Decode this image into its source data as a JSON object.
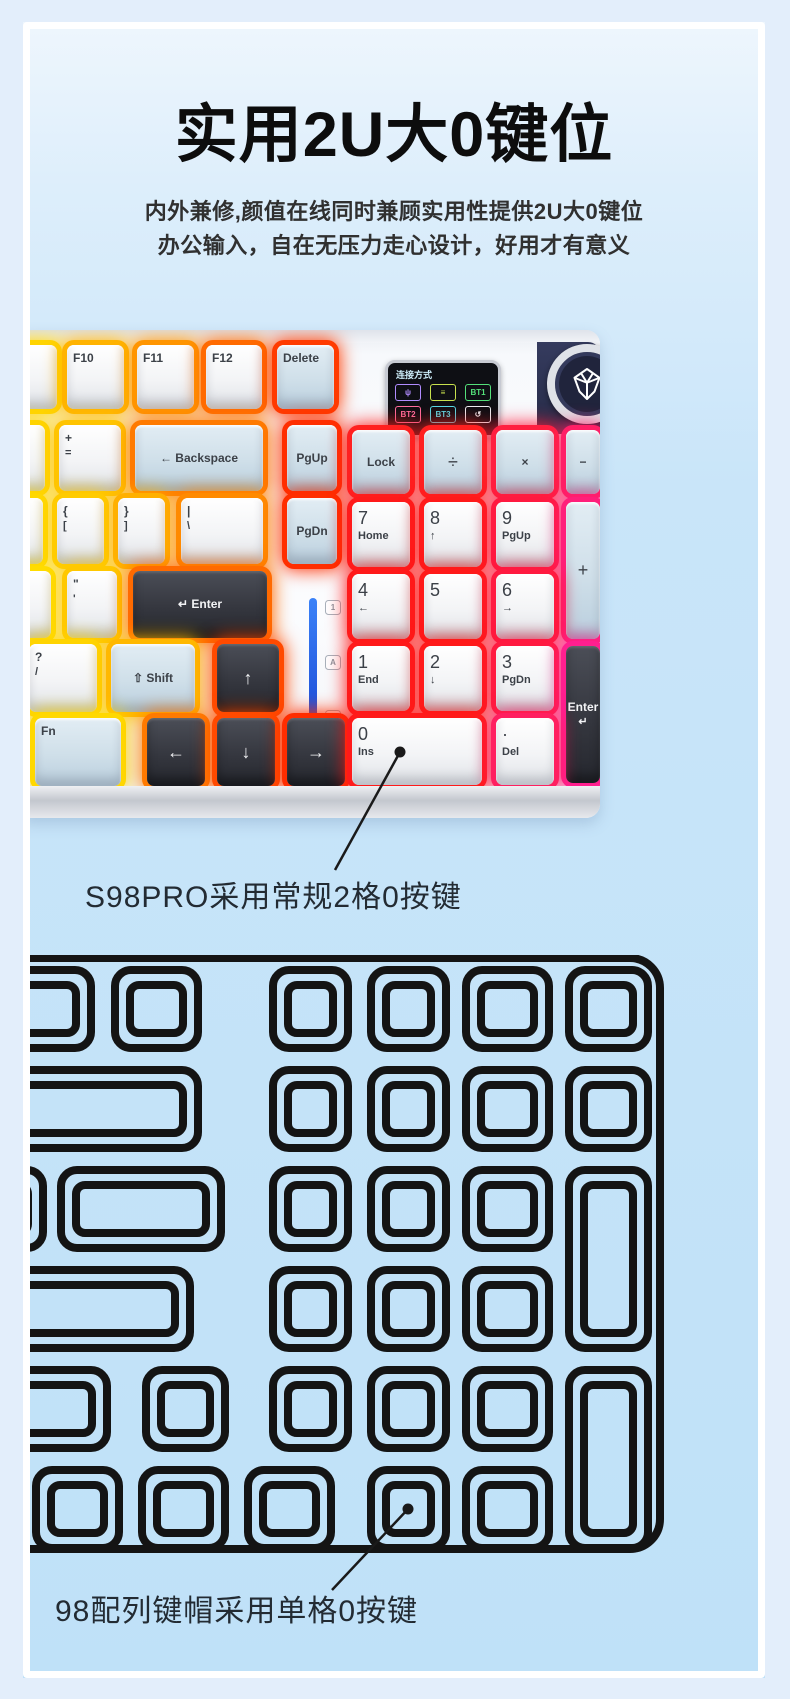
{
  "page": {
    "title": "实用2U大0键位",
    "subtitle_line1": "内外兼修,颜值在线同时兼顾实用性提供2U大0键位",
    "subtitle_line2": "办公输入，自在无压力走心设计，好用才有意义",
    "callout_photo": "S98PRO采用常规2格0按键",
    "callout_lineart": "98配列键帽采用单格0按键"
  },
  "colors": {
    "lineart_stroke": "#141414",
    "callout_line": "#1a1a1a",
    "annotation_text": "#232b33",
    "indicator_bar": "#2b6bf3",
    "knob_panel": "#2b3050"
  },
  "screen": {
    "label": "连接方式",
    "icons": [
      {
        "name": "usb-icon",
        "glyph": "ψ",
        "color": "#b18cff"
      },
      {
        "name": "wired-icon",
        "glyph": "≡",
        "color": "#c8e14e"
      },
      {
        "name": "bt1-badge",
        "glyph": "BT1",
        "color": "#54e07a"
      },
      {
        "name": "bt2-badge",
        "glyph": "BT2",
        "color": "#ff6e9e"
      },
      {
        "name": "bt3-badge",
        "glyph": "BT3",
        "color": "#55dbe8"
      },
      {
        "name": "return-icon",
        "glyph": "↺",
        "color": "#eceff3"
      }
    ]
  },
  "indicators": [
    "1",
    "A",
    "⇩"
  ],
  "photo_keys": [
    {
      "x": -14,
      "y": 15,
      "w": 48,
      "h": 64,
      "glow": "#ffd400",
      "style": "w",
      "label": "F9"
    },
    {
      "x": 44,
      "y": 15,
      "w": 57,
      "h": 64,
      "glow": "#ffb300",
      "style": "w",
      "label": "F10"
    },
    {
      "x": 114,
      "y": 15,
      "w": 57,
      "h": 64,
      "glow": "#ff9500",
      "style": "w",
      "label": "F11"
    },
    {
      "x": 183,
      "y": 15,
      "w": 56,
      "h": 64,
      "glow": "#ff6a00",
      "style": "w",
      "label": "F12"
    },
    {
      "x": 254,
      "y": 15,
      "w": 57,
      "h": 64,
      "glow": "#ff3b00",
      "style": "b",
      "label": "Delete"
    },
    {
      "x": -14,
      "y": 95,
      "w": 36,
      "h": 66,
      "glow": "#ffd400",
      "style": "w",
      "label": "-"
    },
    {
      "x": 36,
      "y": 95,
      "w": 62,
      "h": 66,
      "glow": "#ffc400",
      "style": "w",
      "label": "+",
      "sub": "="
    },
    {
      "x": 112,
      "y": 95,
      "w": 128,
      "h": 66,
      "glow": "#ff7a00",
      "style": "b",
      "label": "← Backspace",
      "center": true
    },
    {
      "x": 264,
      "y": 95,
      "w": 50,
      "h": 66,
      "glow": "#ff2e00",
      "style": "b",
      "label": "PgUp",
      "center": true
    },
    {
      "x": -14,
      "y": 168,
      "w": 34,
      "h": 66,
      "glow": "#ffd800",
      "style": "w",
      "label": ""
    },
    {
      "x": 34,
      "y": 168,
      "w": 47,
      "h": 66,
      "glow": "#ffcb00",
      "style": "w",
      "label": "{",
      "sub": "["
    },
    {
      "x": 95,
      "y": 168,
      "w": 47,
      "h": 66,
      "glow": "#ffb000",
      "style": "w",
      "label": "}",
      "sub": "]"
    },
    {
      "x": 158,
      "y": 168,
      "w": 82,
      "h": 66,
      "glow": "#ff8a00",
      "style": "w",
      "label": "|",
      "sub": "\\"
    },
    {
      "x": 264,
      "y": 168,
      "w": 50,
      "h": 66,
      "glow": "#ff2e00",
      "style": "b",
      "label": "PgDn",
      "center": true
    },
    {
      "x": -14,
      "y": 241,
      "w": 42,
      "h": 67,
      "glow": "#ffdc00",
      "style": "w",
      "label": ""
    },
    {
      "x": 44,
      "y": 241,
      "w": 50,
      "h": 67,
      "glow": "#ffc800",
      "style": "w",
      "label": "\"",
      "sub": "'"
    },
    {
      "x": 110,
      "y": 241,
      "w": 134,
      "h": 67,
      "glow": "#ff6a00",
      "style": "d",
      "label": "↵ Enter",
      "center": true
    },
    {
      "x": 6,
      "y": 314,
      "w": 68,
      "h": 68,
      "glow": "#ffd400",
      "style": "w",
      "label": "?",
      "sub": "/"
    },
    {
      "x": 88,
      "y": 314,
      "w": 84,
      "h": 68,
      "glow": "#ffb800",
      "style": "b",
      "label": "⇧ Shift",
      "center": true
    },
    {
      "x": 194,
      "y": 314,
      "w": 62,
      "h": 68,
      "glow": "#ff4a00",
      "style": "d",
      "label": "↑",
      "center": true,
      "big": true
    },
    {
      "x": 12,
      "y": 388,
      "w": 86,
      "h": 68,
      "glow": "#ffd800",
      "style": "b",
      "label": "Fn"
    },
    {
      "x": 124,
      "y": 388,
      "w": 58,
      "h": 68,
      "glow": "#ff7a00",
      "style": "d",
      "label": "←",
      "center": true,
      "big": true
    },
    {
      "x": 194,
      "y": 388,
      "w": 58,
      "h": 68,
      "glow": "#ff4a00",
      "style": "d",
      "label": "↓",
      "center": true,
      "big": true
    },
    {
      "x": 264,
      "y": 388,
      "w": 58,
      "h": 68,
      "glow": "#ff2d00",
      "style": "d",
      "label": "→",
      "center": true,
      "big": true
    },
    {
      "x": 329,
      "y": 100,
      "w": 58,
      "h": 64,
      "glow": "#ff2020",
      "style": "b",
      "label": "Lock",
      "center": true
    },
    {
      "x": 401,
      "y": 100,
      "w": 58,
      "h": 64,
      "glow": "#ff2020",
      "style": "b",
      "label": "÷",
      "center": true,
      "big": true
    },
    {
      "x": 473,
      "y": 100,
      "w": 58,
      "h": 64,
      "glow": "#ff2040",
      "style": "b",
      "label": "×",
      "center": true
    },
    {
      "x": 543,
      "y": 100,
      "w": 34,
      "h": 64,
      "glow": "#ff1f66",
      "style": "b",
      "label": "−",
      "center": true
    },
    {
      "x": 329,
      "y": 172,
      "w": 58,
      "h": 65,
      "glow": "#ff1a1a",
      "style": "w",
      "label": "7",
      "sub": "Home",
      "big": true
    },
    {
      "x": 401,
      "y": 172,
      "w": 58,
      "h": 65,
      "glow": "#ff1a1a",
      "style": "w",
      "label": "8",
      "sub": "↑",
      "big": true
    },
    {
      "x": 473,
      "y": 172,
      "w": 58,
      "h": 65,
      "glow": "#ff1a40",
      "style": "w",
      "label": "9",
      "sub": "PgUp",
      "big": true
    },
    {
      "x": 543,
      "y": 172,
      "w": 34,
      "h": 137,
      "glow": "#ff1f7a",
      "style": "b",
      "label": "+",
      "center": true,
      "big": true
    },
    {
      "x": 329,
      "y": 244,
      "w": 58,
      "h": 65,
      "glow": "#ff1a1a",
      "style": "w",
      "label": "4",
      "sub": "←",
      "big": true
    },
    {
      "x": 401,
      "y": 244,
      "w": 58,
      "h": 65,
      "glow": "#ff1a1a",
      "style": "w",
      "label": "5",
      "big": true
    },
    {
      "x": 473,
      "y": 244,
      "w": 58,
      "h": 65,
      "glow": "#ff1a40",
      "style": "w",
      "label": "6",
      "sub": "→",
      "big": true
    },
    {
      "x": 329,
      "y": 316,
      "w": 58,
      "h": 65,
      "glow": "#ff1a1a",
      "style": "w",
      "label": "1",
      "sub": "End",
      "big": true
    },
    {
      "x": 401,
      "y": 316,
      "w": 58,
      "h": 65,
      "glow": "#ff1a1a",
      "style": "w",
      "label": "2",
      "sub": "↓",
      "big": true
    },
    {
      "x": 473,
      "y": 316,
      "w": 58,
      "h": 65,
      "glow": "#ff1a40",
      "style": "w",
      "label": "3",
      "sub": "PgDn",
      "big": true
    },
    {
      "x": 543,
      "y": 316,
      "w": 34,
      "h": 137,
      "glow": "#ff1f8f",
      "style": "d",
      "label": "Enter",
      "sub": "↵",
      "center": true
    },
    {
      "x": 329,
      "y": 388,
      "w": 130,
      "h": 67,
      "glow": "#ff1a1a",
      "style": "w",
      "label": "0",
      "sub": "Ins",
      "big": true
    },
    {
      "x": 473,
      "y": 388,
      "w": 58,
      "h": 67,
      "glow": "#ff1f60",
      "style": "w",
      "label": "·",
      "sub": "Del",
      "big": true
    }
  ],
  "lineart": {
    "outline": {
      "x": -200,
      "y": 3,
      "w": 837,
      "h": 591,
      "rx": 30
    },
    "keys": [
      [
        -70,
        15,
        138,
        78
      ],
      [
        92,
        15,
        83,
        78
      ],
      [
        250,
        15,
        75,
        78
      ],
      [
        348,
        15,
        75,
        78
      ],
      [
        443,
        15,
        83,
        78
      ],
      [
        546,
        15,
        79,
        78
      ],
      [
        -70,
        115,
        245,
        78
      ],
      [
        250,
        115,
        75,
        78
      ],
      [
        348,
        115,
        75,
        78
      ],
      [
        443,
        115,
        83,
        78
      ],
      [
        546,
        115,
        79,
        78
      ],
      [
        -70,
        215,
        90,
        78
      ],
      [
        38,
        215,
        160,
        78
      ],
      [
        250,
        215,
        75,
        78
      ],
      [
        348,
        215,
        75,
        78
      ],
      [
        443,
        215,
        83,
        78
      ],
      [
        546,
        215,
        79,
        178
      ],
      [
        -70,
        315,
        237,
        78
      ],
      [
        250,
        315,
        75,
        78
      ],
      [
        348,
        315,
        75,
        78
      ],
      [
        443,
        315,
        83,
        78
      ],
      [
        -70,
        415,
        154,
        78
      ],
      [
        123,
        415,
        79,
        78
      ],
      [
        250,
        415,
        75,
        78
      ],
      [
        348,
        415,
        75,
        78
      ],
      [
        443,
        415,
        83,
        78
      ],
      [
        546,
        415,
        79,
        178
      ],
      [
        13,
        515,
        83,
        78
      ],
      [
        119,
        515,
        83,
        78
      ],
      [
        225,
        515,
        83,
        78
      ],
      [
        348,
        515,
        75,
        78
      ],
      [
        443,
        515,
        83,
        78
      ]
    ]
  },
  "callouts": {
    "dots": [
      [
        377,
        730
      ],
      [
        385,
        1487
      ]
    ],
    "lines": [
      [
        377,
        730,
        312,
        848
      ],
      [
        385,
        1487,
        309,
        1568
      ]
    ]
  }
}
